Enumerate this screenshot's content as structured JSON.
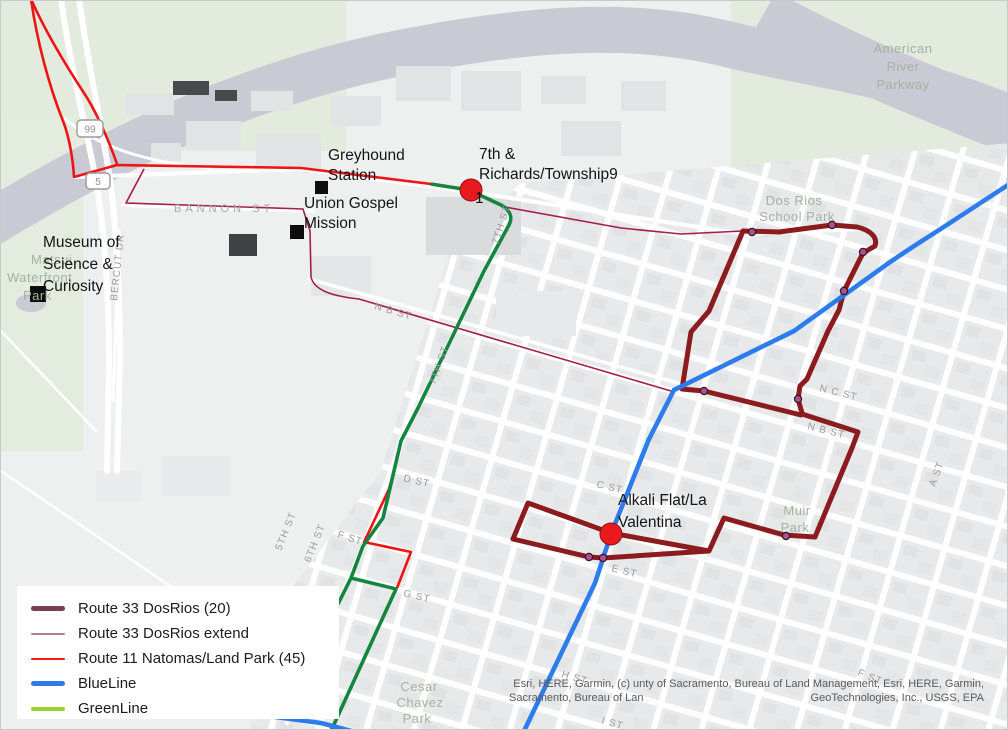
{
  "labels": {
    "richards_line1": "7th &",
    "richards_line2": "Richards/Township9",
    "richards_stop_num": "1",
    "greyhound_line1": "Greyhound",
    "greyhound_line2": "Station",
    "gospel_line1": "Union Gospel",
    "gospel_line2": "Mission",
    "museum_line1": "Museum of",
    "museum_line2": "Science &",
    "museum_line3": "Curiosity",
    "alkali_line1": "Alkali Flat/La",
    "alkali_line2": "Valentina"
  },
  "streets": {
    "bannon": "BANNON ST",
    "nb1": "N B ST",
    "nc": "N C ST",
    "nb2": "N B ST",
    "c": "C ST",
    "d": "D ST",
    "e": "E ST",
    "f1": "F ST",
    "g": "G ST",
    "h": "H ST",
    "f2": "F ST",
    "i": "I ST",
    "fifth": "5TH ST",
    "sixth": "6TH ST",
    "seventh1": "7TH ST",
    "seventh2": "7TH ST",
    "a": "A ST",
    "bercut": "BERCUT DR"
  },
  "parks": {
    "arp1": "American",
    "arp2": "River",
    "arp3": "Parkway",
    "dos1": "Dos Rios",
    "dos2": "School Park",
    "muir1": "Muir",
    "muir2": "Park",
    "cesar1": "Cesar",
    "cesar2": "Chavez",
    "cesar3": "Park",
    "matsui1": "Matsui",
    "matsui2": "Waterfront",
    "matsui3": "Park"
  },
  "shields": {
    "s99": "99",
    "s5": "5"
  },
  "legend": {
    "items": [
      {
        "label": "Route 33 DosRios (20)",
        "color": "#7a3e53",
        "height": 5
      },
      {
        "label": "Route 33 DosRios extend",
        "color": "#b27e90",
        "height": 2
      },
      {
        "label": "Route 11 Natomas/Land Park (45)",
        "color": "#f01d1d",
        "height": 2
      },
      {
        "label": "BlueLine",
        "color": "#2d7cec",
        "height": 5
      },
      {
        "label": "GreenLine",
        "color": "#9ccf2d",
        "height": 4
      }
    ]
  },
  "attribution": {
    "line1": "Esri, HERE, Garmin, (c) unty of Sacramento, Bureau of Land Management, Esri, HERE, Garmin,",
    "line2_left": "Sacramento, Bureau of Lan",
    "line2_right": "GeoTechnologies, Inc., USGS, EPA"
  },
  "route_colors": {
    "route33": "#8b1b1e",
    "route33_extend": "#a51e49",
    "route11": "#ee1414",
    "blue_line": "#2d7cec",
    "green_line": "#148540",
    "stop_dot": "#a8538a",
    "station_red": "#e8191f"
  }
}
